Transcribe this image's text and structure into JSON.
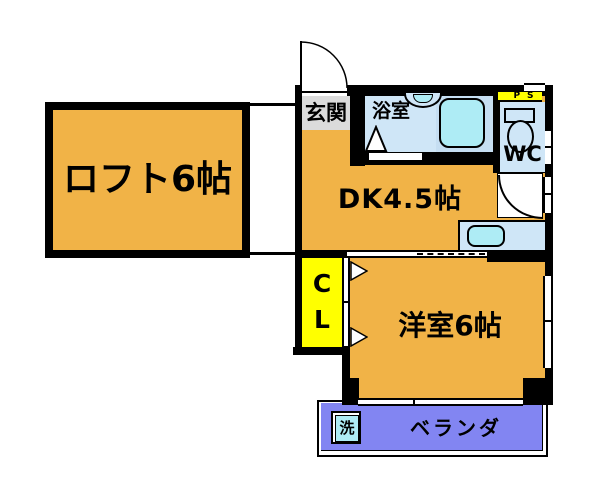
{
  "colors": {
    "room_orange": "#F1B347",
    "wet_blue": "#CFE6F7",
    "bath_panel_blue": "#C5DEF2",
    "fixture_cyan": "#AEECF5",
    "closet_yellow": "#FFFF00",
    "ps_yellow": "#FFFF00",
    "veranda_purple": "#8285F2",
    "entry_gray": "#DBDBDB",
    "wall_black": "#000000"
  },
  "rooms": {
    "loft": {
      "label": "ロフト6帖"
    },
    "entry": {
      "label": "玄関"
    },
    "bathroom": {
      "label": "浴室"
    },
    "wc": {
      "label": "WC"
    },
    "pipe_space": {
      "label": "PS"
    },
    "dining_kitchen": {
      "label": "DK4.5帖"
    },
    "closet": {
      "line1": "C",
      "line2": "L"
    },
    "western_room": {
      "label": "洋室6帖"
    },
    "veranda": {
      "label": "ベランダ"
    },
    "washer": {
      "label": "洗"
    }
  }
}
